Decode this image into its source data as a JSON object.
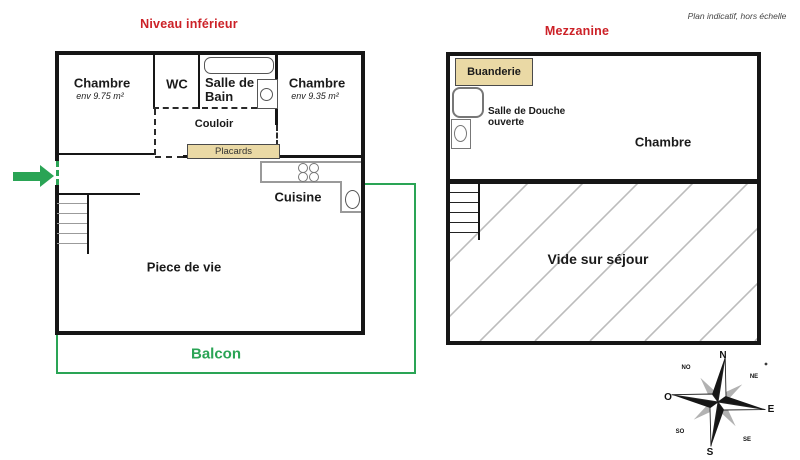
{
  "disclaimer": "Plan indicatif, hors échelle",
  "colors": {
    "red": "#cc2127",
    "green": "#2aa455",
    "tan": "#ead9a5",
    "hatch": "#bcbcbc"
  },
  "lower": {
    "title": "Niveau inférieur",
    "bedroom1": "Chambre",
    "bedroom1_area": "env 9.75 m²",
    "wc": "WC",
    "bathroom": "Salle de Bain",
    "bedroom2": "Chambre",
    "bedroom2_area": "env 9.35 m²",
    "hallway": "Couloir",
    "closets": "Placards",
    "kitchen": "Cuisine",
    "living": "Piece de vie",
    "balcony": "Balcon"
  },
  "mezzanine": {
    "title": "Mezzanine",
    "laundry": "Buanderie",
    "shower": "Salle de Douche ouverte",
    "bedroom": "Chambre",
    "void": "Vide sur séjour"
  },
  "compass": {
    "n": "N",
    "ne": "NE",
    "e": "E",
    "se": "SE",
    "s": "S",
    "sw": "SO",
    "w": "O",
    "nw": "NO"
  }
}
